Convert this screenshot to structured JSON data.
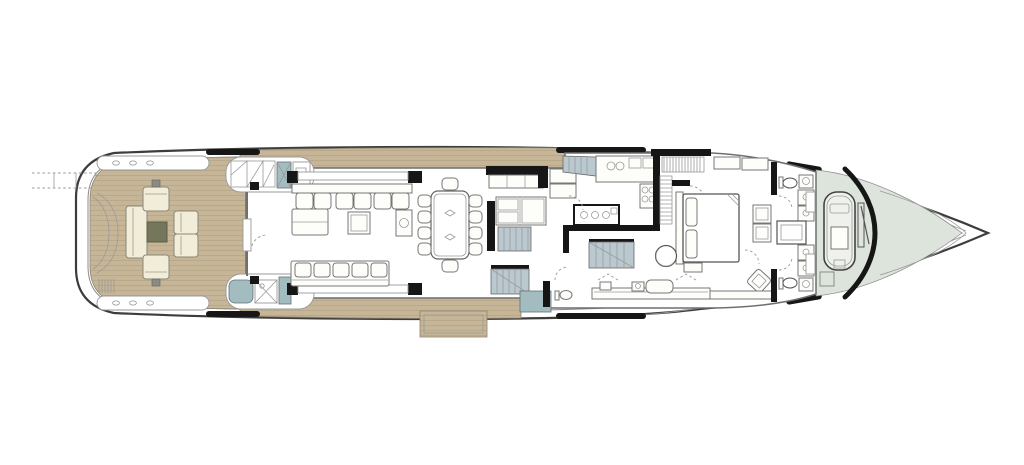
{
  "diagram": {
    "type": "yacht-deck-plan",
    "deck": "main-deck",
    "orientation": "bow-right",
    "aria_label": "Yacht main deck floor plan, bow to the right"
  },
  "colors": {
    "hull_line": "#3d3d3d",
    "bulwark_line": "#8a8a8a",
    "teak": "#c6b697",
    "teak_plank": "#b4a386",
    "teak_border": "#8e8370",
    "wall": "#6f6f6f",
    "light": "#9a9a9a",
    "black": "#161616",
    "cream": "#f2edd8",
    "cream_border": "#8a8878",
    "olive": "#75775c",
    "olive_border": "#5c5e49",
    "teal": "#a3bcc0",
    "stair": "#bac9cf",
    "sage": "#dde4dc",
    "white_furniture": "#fdfdfa",
    "furniture_line": "#777777",
    "tender_fill": "#eef1ec"
  },
  "spaces": [
    {
      "id": "stern-platform",
      "furnishings": [
        "passerelle",
        "transom-garage",
        "boarding-steps",
        "cleats"
      ]
    },
    {
      "id": "aft-deck",
      "furnishings": [
        "sofa",
        "coffee-table",
        "2-armchairs",
        "2-club-chairs",
        "side-tables"
      ]
    },
    {
      "id": "aft-stair-starboard",
      "furnishings": [
        "steps",
        "locker"
      ]
    },
    {
      "id": "aft-bar-port",
      "furnishings": [
        "grill",
        "locker"
      ]
    },
    {
      "id": "main-salon",
      "furnishings": [
        "l-shaped-sofa",
        "sofa",
        "coffee-table",
        "side-table",
        "sideboard"
      ]
    },
    {
      "id": "dining-area",
      "furnishings": [
        "dining-table",
        "10-chairs"
      ]
    },
    {
      "id": "stair-lobby",
      "furnishings": [
        "settee",
        "stairs-down",
        "side-entry-steps",
        "shell-door"
      ]
    },
    {
      "id": "day-head",
      "furnishings": [
        "wc"
      ]
    },
    {
      "id": "galley",
      "furnishings": [
        "island-cooktop",
        "sink-counter",
        "range",
        "refrigerator",
        "tall-units",
        "crew-stairs"
      ]
    },
    {
      "id": "walk-in-wardrobe",
      "furnishings": [
        "hanging-rails"
      ]
    },
    {
      "id": "master-cabin",
      "furnishings": [
        "double-bed",
        "foot-bench",
        "round-armchair",
        "corner-armchair",
        "vanity-console",
        "seat",
        "wardrobes"
      ]
    },
    {
      "id": "bathroom-starboard",
      "furnishings": [
        "wc",
        "washbasin",
        "shower-units"
      ]
    },
    {
      "id": "bathroom-port",
      "furnishings": [
        "wc",
        "washbasin",
        "shower-units"
      ]
    },
    {
      "id": "foredeck",
      "furnishings": [
        "tender",
        "crane",
        "deck-hatches",
        "windshield"
      ]
    },
    {
      "id": "side-balcony-port",
      "furnishings": [
        "fold-out-platform"
      ]
    }
  ]
}
